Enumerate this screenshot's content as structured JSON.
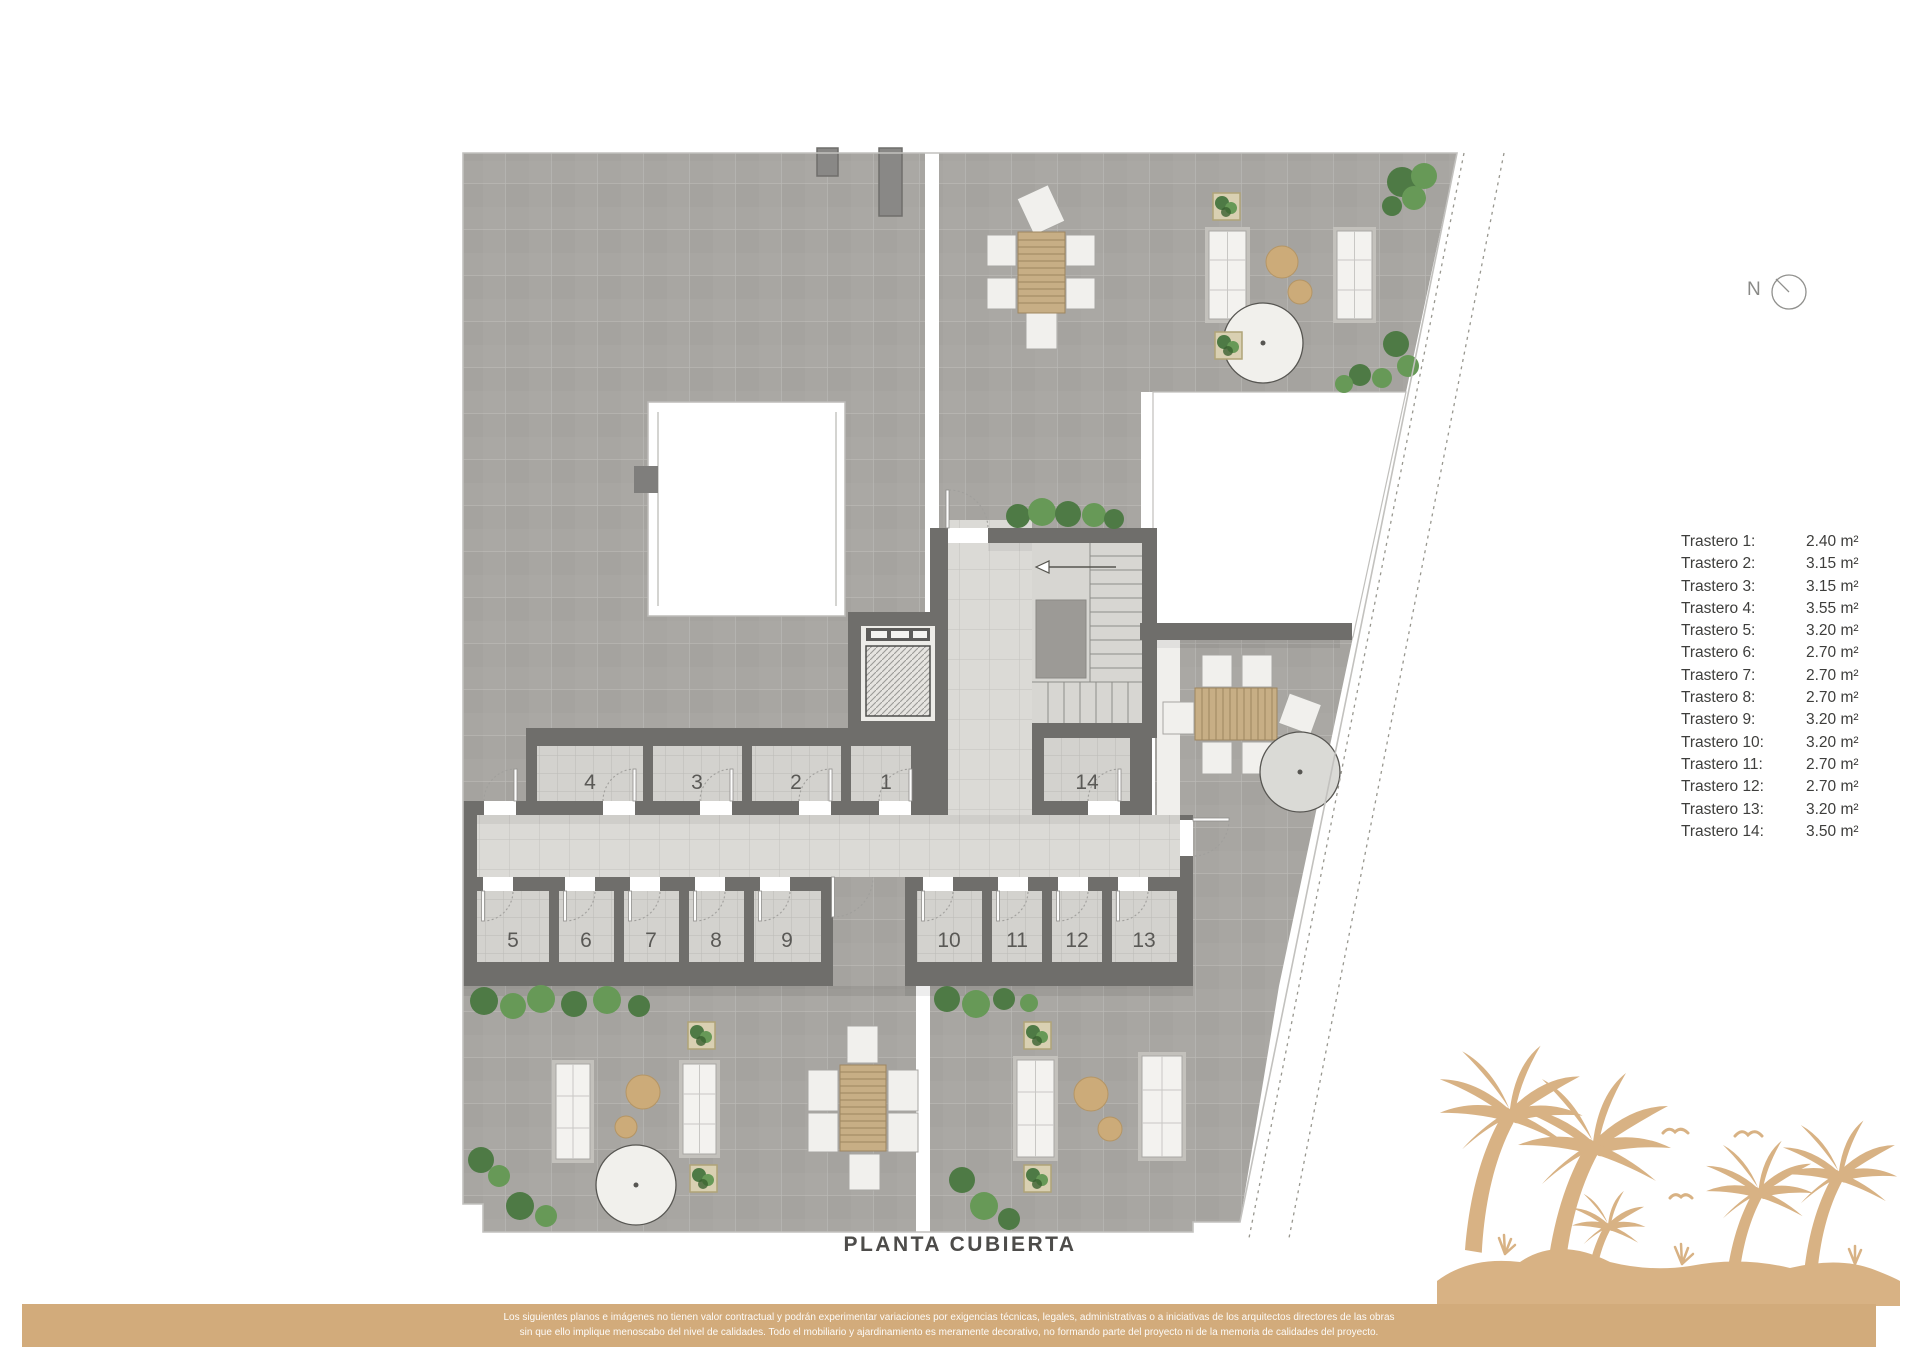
{
  "plan": {
    "title": "PLANTA CUBIERTA",
    "compass_label": "N",
    "rooms": [
      "1",
      "2",
      "3",
      "4",
      "5",
      "6",
      "7",
      "8",
      "9",
      "10",
      "11",
      "12",
      "13",
      "14"
    ]
  },
  "legend": {
    "items": [
      {
        "label": "Trastero 1:",
        "value": "2.40 m²"
      },
      {
        "label": "Trastero 2:",
        "value": "3.15 m²"
      },
      {
        "label": "Trastero 3:",
        "value": "3.15 m²"
      },
      {
        "label": "Trastero 4:",
        "value": "3.55 m²"
      },
      {
        "label": "Trastero 5:",
        "value": "3.20 m²"
      },
      {
        "label": "Trastero 6:",
        "value": "2.70 m²"
      },
      {
        "label": "Trastero 7:",
        "value": "2.70 m²"
      },
      {
        "label": "Trastero 8:",
        "value": "2.70 m²"
      },
      {
        "label": "Trastero 9:",
        "value": "3.20 m²"
      },
      {
        "label": "Trastero 10:",
        "value": "3.20 m²"
      },
      {
        "label": "Trastero 11:",
        "value": "2.70 m²"
      },
      {
        "label": "Trastero 12:",
        "value": "2.70 m²"
      },
      {
        "label": "Trastero 13:",
        "value": "3.20 m²"
      },
      {
        "label": "Trastero 14:",
        "value": "3.50 m²"
      }
    ]
  },
  "footer": {
    "line1": "Los siguientes planos e imágenes no tienen valor contractual y podrán experimentar variaciones por exigencias técnicas, legales, administrativas o a iniciativas de los arquitectos directores de las obras",
    "line2": "sin que ello implique menoscabo del nivel de calidades. Todo el mobiliario y ajardinamiento es meramente decorativo, no formando parte del proyecto ni de la memoria de calidades del proyecto."
  },
  "colors": {
    "accent_tan": "#d2ab7b",
    "palm_tan": "#d8b284",
    "wall_gray": "#6f6e6b",
    "terrace_gray": "#a8a6a2",
    "corridor_gray": "#dbdad6",
    "bush_green": "#4e7a45",
    "title_text": "#4d4c4a"
  }
}
